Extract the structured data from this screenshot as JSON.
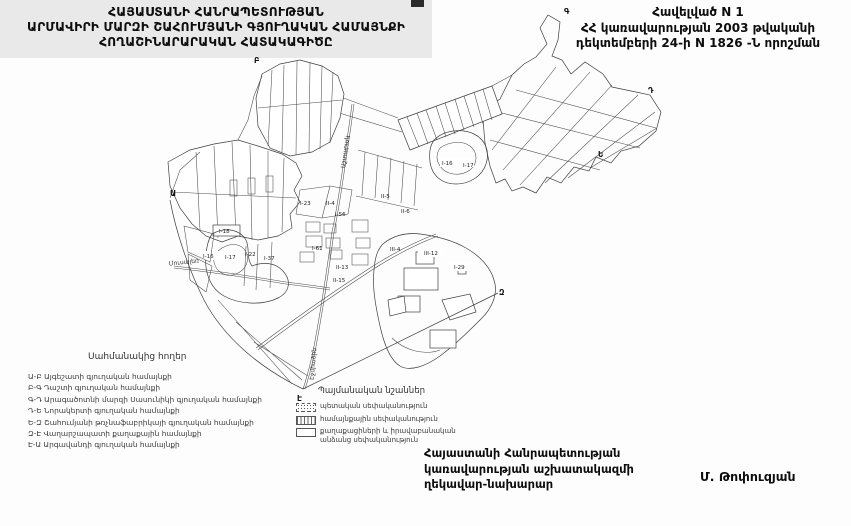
{
  "colors": {
    "paper": "#fdfdfd",
    "ink": "#0d0d0d",
    "map_line": "#3f3f3f",
    "backdrop": "#e9e9e9"
  },
  "header": {
    "title_lines": [
      "ՀԱՅԱՍՏԱՆԻ ՀԱՆՐԱՊԵՏՈՒԹՅԱՆ",
      "ԱՐՄԱՎԻՐԻ ՄԱՐԶԻ ՇԱՀՈՒՄՅԱՆԻ ԳՅՈՒՂԱԿԱՆ ՀԱՄԱՅՆՔԻ",
      "ՀՈՂԱՇԻՆԱՐԱՐԱԿԱՆ ՀԱՏԱԿԱԳԻԾԸ"
    ],
    "annex_lines": [
      "Հավելված N 1",
      "ՀՀ կառավարության 2003 թվականի",
      "դեկտեմբերի 24-ի N 1826 -Ն որոշման"
    ]
  },
  "legend_adjacent": {
    "title": "Սահմանակից հողեր",
    "items": [
      "Ա-Բ Այգեշատի գյուղական համայնքի",
      "Բ-Գ Դաշտի գյուղական համայնքի",
      "Գ-Դ Արագածոտնի մարզի Սասունիկի գյուղական համայնքի",
      "Դ-Ե Նորակերտի գյուղական համայնքի",
      "Ե-Զ Շահումյանի թռչնաֆաբրիկայի գյուղական համայնքի",
      "Զ-Է Վաղարշապատի քաղաքային համայնքի",
      "Է-Ա Արգավանդի գյուղական համայնքի"
    ]
  },
  "legend_symbols": {
    "title": "Պայմանական նշաններ",
    "items": [
      {
        "pattern": "stipple",
        "label": "պետական սեփականություն"
      },
      {
        "pattern": "hatch",
        "label": "համայնքային սեփականություն"
      },
      {
        "pattern": "blank",
        "label": "քաղաքացիների և իրավաբանական անձանց սեփականություն"
      }
    ]
  },
  "signature": {
    "lines": [
      "Հայաստանի Հանրապետության",
      "կառավարության աշխատակազմի",
      "ղեկավար-նախարար"
    ],
    "name": "Մ. Թոփուզյան"
  },
  "map": {
    "parcel_labels": [
      {
        "t": "I-18",
        "x": 219,
        "y": 233
      },
      {
        "t": "I-23",
        "x": 300,
        "y": 205
      },
      {
        "t": "II-4",
        "x": 326,
        "y": 205
      },
      {
        "t": "I-56",
        "x": 335,
        "y": 216
      },
      {
        "t": "II-5",
        "x": 381,
        "y": 198
      },
      {
        "t": "II-6",
        "x": 401,
        "y": 213
      },
      {
        "t": "III-4",
        "x": 390,
        "y": 251
      },
      {
        "t": "III-12",
        "x": 424,
        "y": 255
      },
      {
        "t": "I-29",
        "x": 454,
        "y": 269
      },
      {
        "t": "I-61",
        "x": 312,
        "y": 250
      },
      {
        "t": "I-22",
        "x": 245,
        "y": 256
      },
      {
        "t": "I-37",
        "x": 264,
        "y": 260
      },
      {
        "t": "II-13",
        "x": 336,
        "y": 269
      },
      {
        "t": "II-15",
        "x": 333,
        "y": 282
      },
      {
        "t": "I-16",
        "x": 203,
        "y": 258
      },
      {
        "t": "I-17",
        "x": 225,
        "y": 259
      },
      {
        "t": "I-16",
        "x": 442,
        "y": 165
      },
      {
        "t": "I-17",
        "x": 463,
        "y": 167
      }
    ],
    "boundary_letters": [
      {
        "t": "Ա",
        "x": 170,
        "y": 196
      },
      {
        "t": "Բ",
        "x": 254,
        "y": 63
      },
      {
        "t": "Գ",
        "x": 564,
        "y": 14
      },
      {
        "t": "Դ",
        "x": 648,
        "y": 93
      },
      {
        "t": "Ե",
        "x": 598,
        "y": 157
      },
      {
        "t": "Զ",
        "x": 499,
        "y": 295
      },
      {
        "t": "Է",
        "x": 297,
        "y": 401
      }
    ],
    "road_labels": [
      {
        "t": "Աշտարակ",
        "x": 347,
        "y": 152,
        "r": -83
      },
      {
        "t": "Մուսալեռ",
        "x": 184,
        "y": 264,
        "r": -6
      },
      {
        "t": "Էջմիածին",
        "x": 315,
        "y": 364,
        "r": -85
      }
    ]
  }
}
